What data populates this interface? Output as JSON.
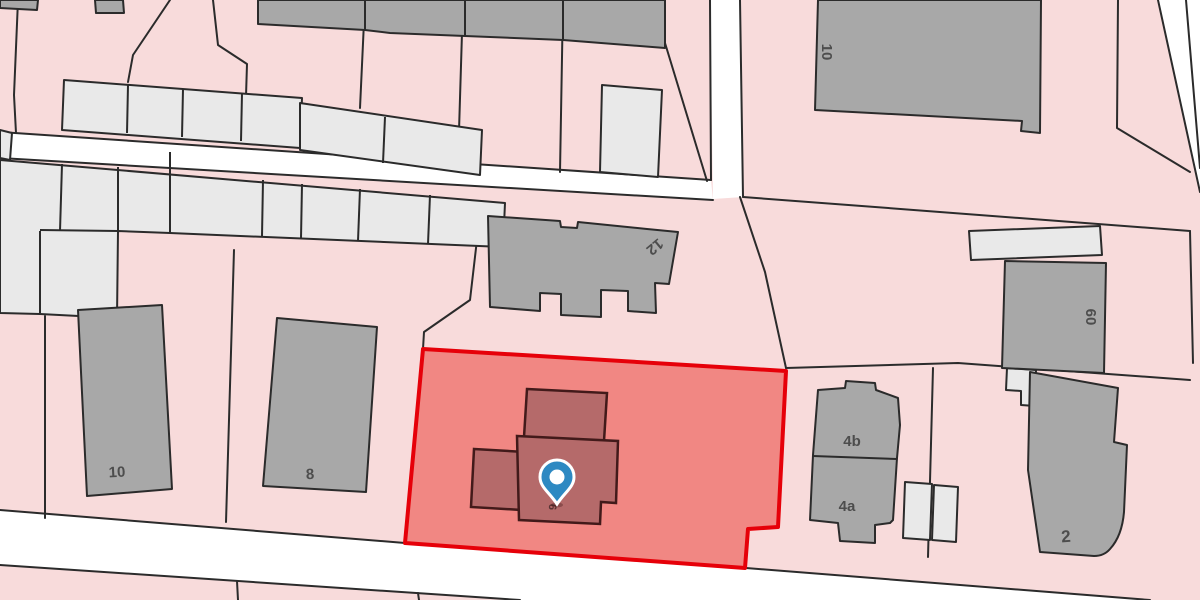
{
  "map": {
    "description": "Cadastral parcel map with highlighted property parcel and blue location marker",
    "marker": {
      "type": "location-pin",
      "pin_color": "#2d89c2",
      "pin_inner_color": "#ffffff"
    },
    "highlight": {
      "parcel_fill": "#f0807c",
      "parcel_border": "#e60009",
      "building_fill": "#b56a6a",
      "building_border": "#421a1a"
    },
    "palette": {
      "parcel_pink": "#f8dbdb",
      "road_white": "#ffffff",
      "building_dark_gray": "#a8a8a8",
      "building_light_gray": "#e9e9e9",
      "boundary_line": "#2b2b2b"
    },
    "house_numbers": {
      "top_right": "10",
      "center": "12",
      "left_first": "10",
      "left_second": "8",
      "highlighted": "6",
      "right_upper": "4b",
      "right_lower": "4a",
      "far_right": "2",
      "far_right_upper": "60"
    }
  }
}
